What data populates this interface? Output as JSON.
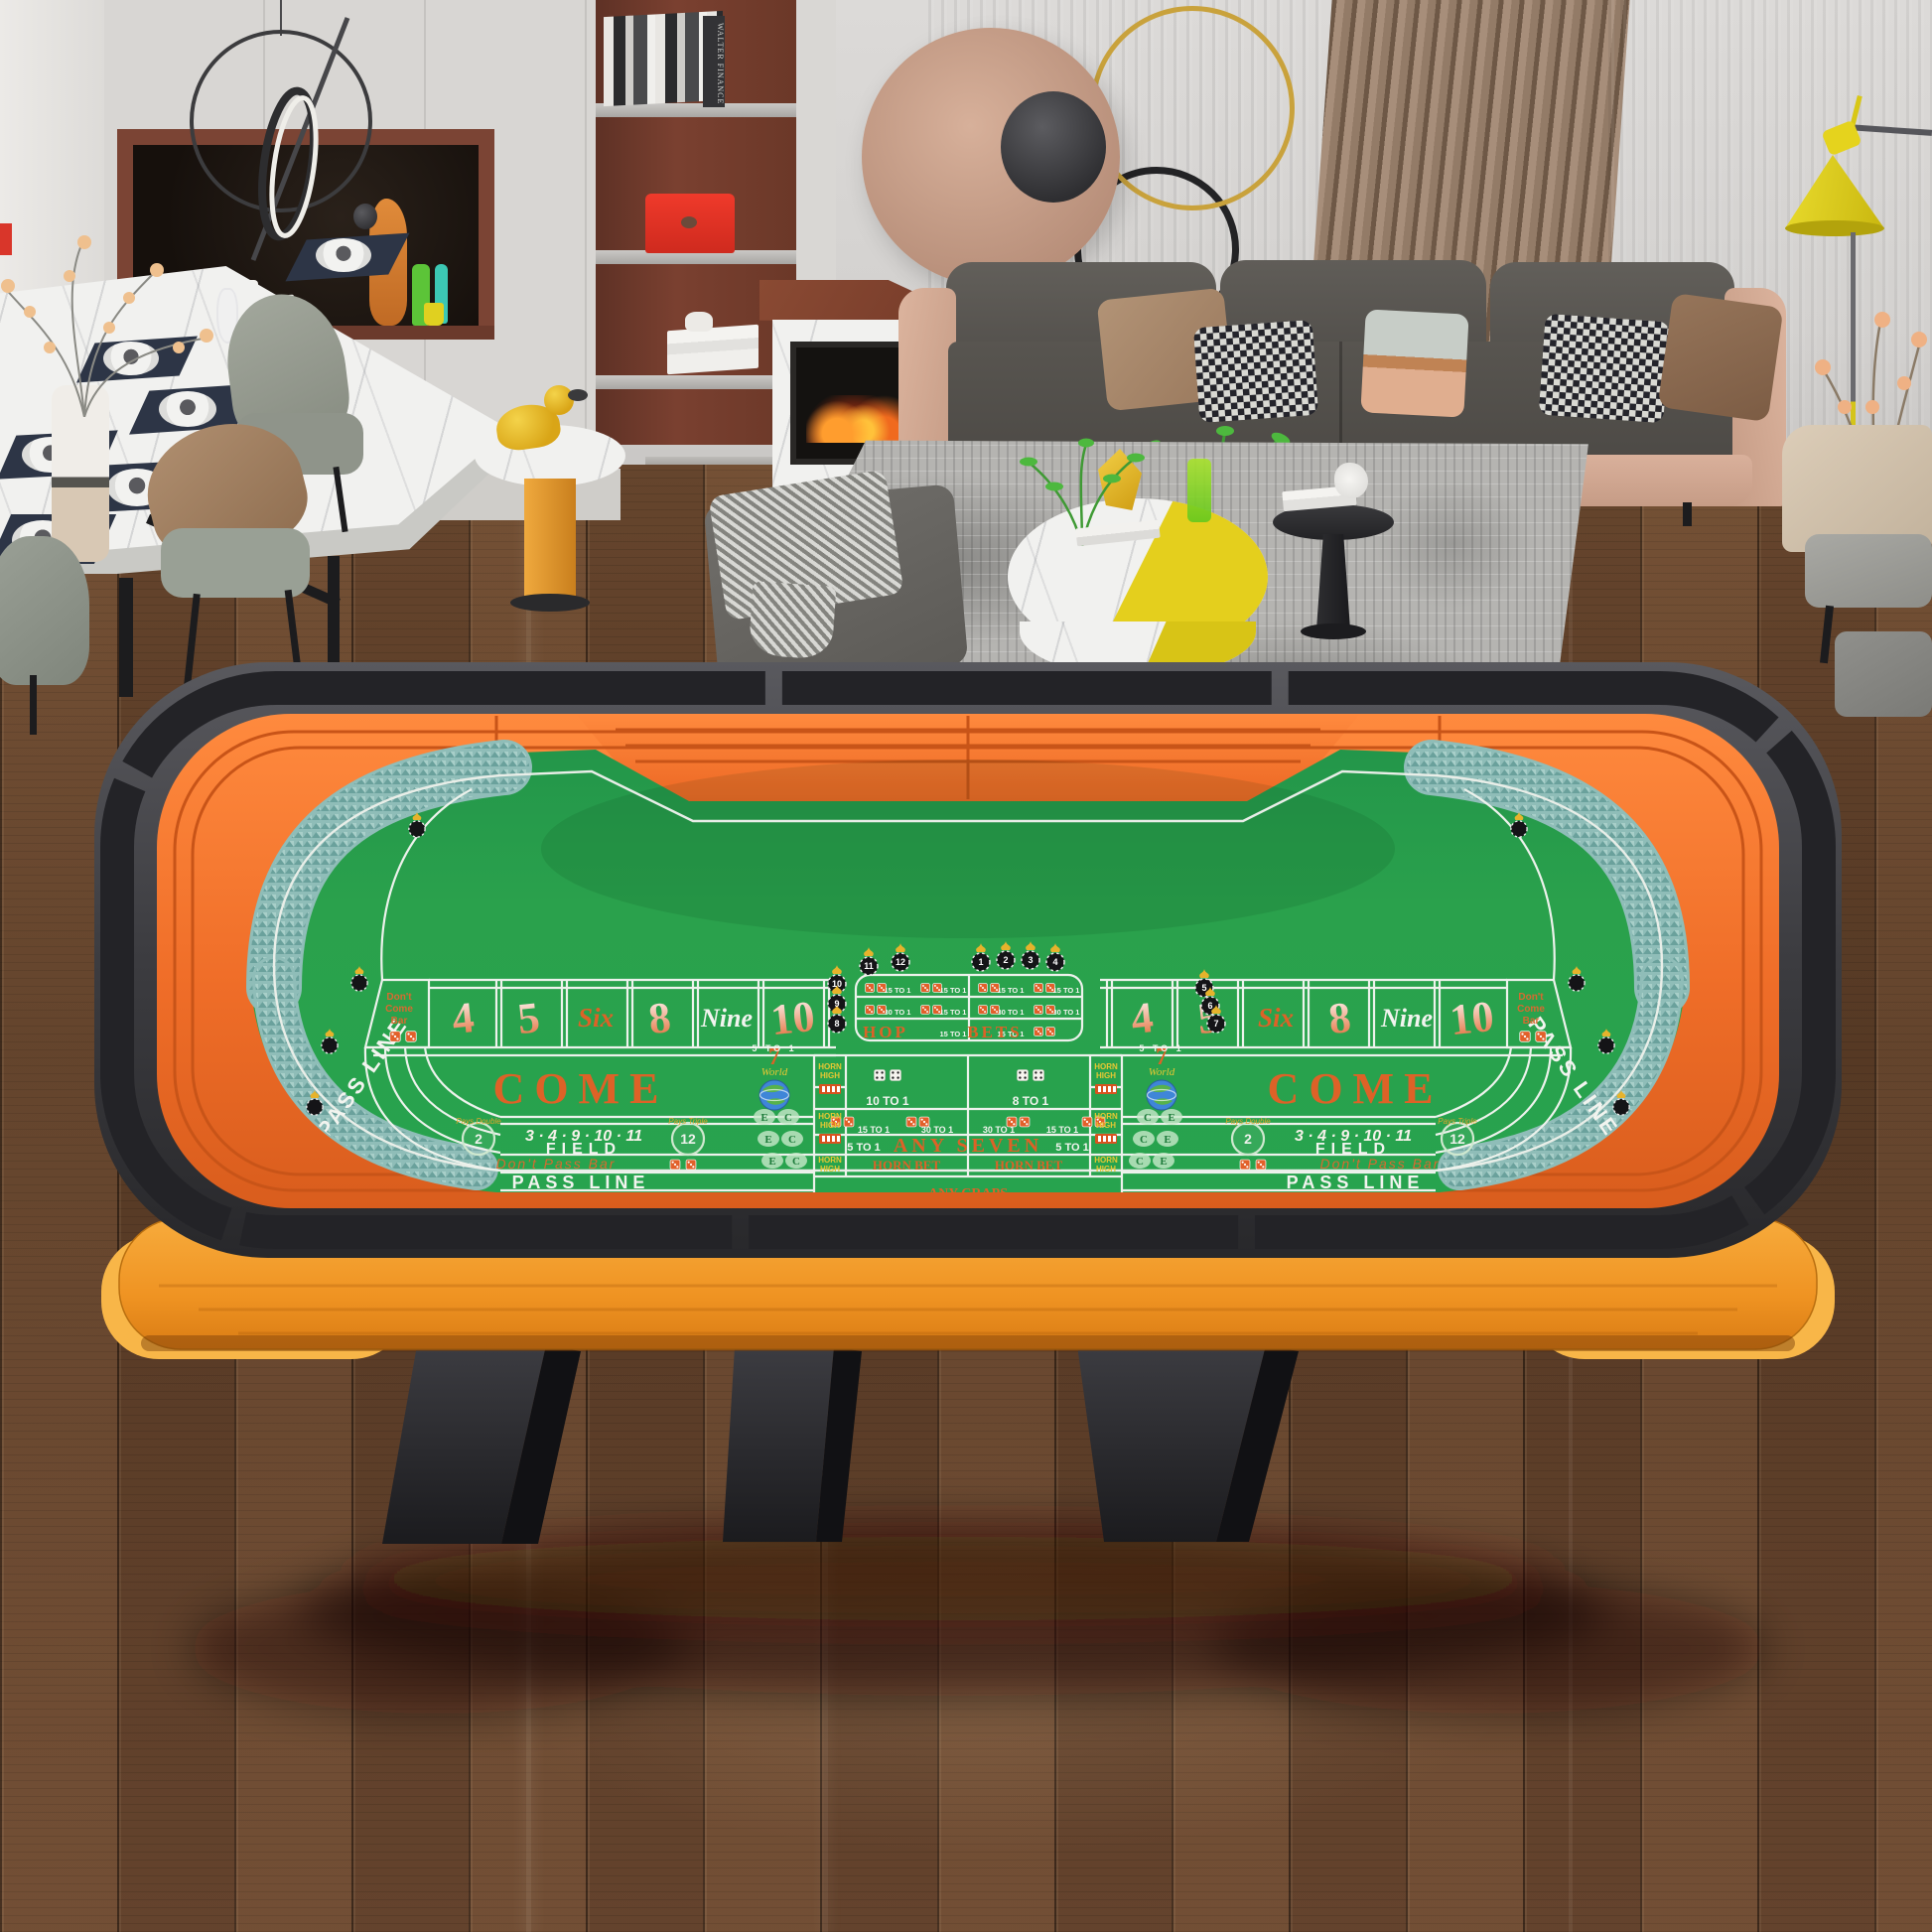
{
  "t": {
    "pass_line": "PASS LINE",
    "come": "COME",
    "field": "FIELD",
    "field_numbers": "3 · 4 · 9 · 10 · 11",
    "two": "2",
    "twelve": "12",
    "pays_double": "Pays Double",
    "pays_triple": "Pays Triple",
    "dont_pass_bar": "Don't Pass Bar",
    "dc": [
      "Don't",
      "Come",
      "Bar"
    ],
    "points": [
      "4",
      "5",
      "Six",
      "8",
      "Nine",
      "10"
    ],
    "hop": "HOP",
    "bets": "BETS",
    "x15": "15 TO 1",
    "x30": "30 TO 1",
    "x10": "10 TO 1",
    "x8": "8 TO 1",
    "x5": "5 TO 1",
    "any_seven": "ANY SEVEN",
    "any_craps": "ANY CRAPS",
    "horn": "HORN",
    "high": "HIGH",
    "horn_bet": "HORN BET",
    "seven": "7",
    "world": "World",
    "c": "C",
    "e": "E",
    "chips": [
      "1",
      "2",
      "3",
      "4",
      "5",
      "6",
      "7",
      "8",
      "9",
      "10",
      "11",
      "12"
    ]
  },
  "room": {
    "book_spine": "WALTER FINANCE"
  },
  "colors": {
    "felt": "#2aa14c",
    "rail_orange": "#f0702c",
    "rim_dark": "#3a3a3e",
    "apron_wood": "#f5a02f",
    "accent_text": "#dd6227",
    "corner_pad": "#8fbdb8",
    "lamp_yellow": "#e5d31d"
  }
}
